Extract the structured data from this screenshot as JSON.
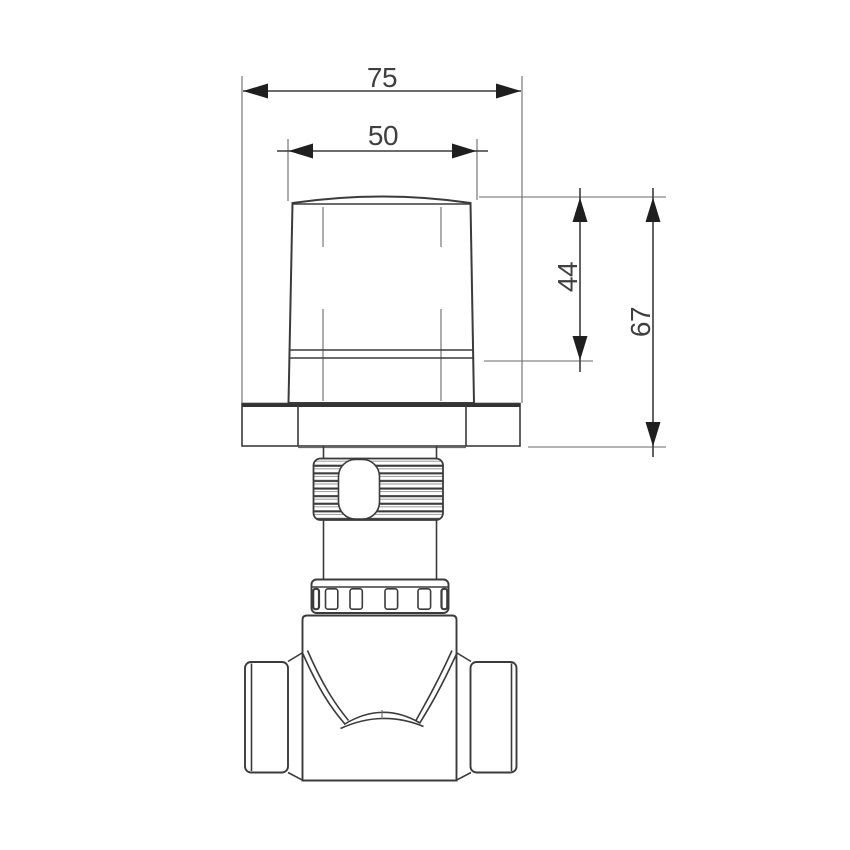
{
  "drawing": {
    "kind": "technical-drawing-front-view",
    "subject": "concealed-valve-with-handle",
    "line_color": "#3b3b3b",
    "background_color": "#ffffff",
    "dimensions": {
      "overall_width": "75",
      "handle_width": "50",
      "handle_height": "44",
      "total_height": "67"
    }
  }
}
